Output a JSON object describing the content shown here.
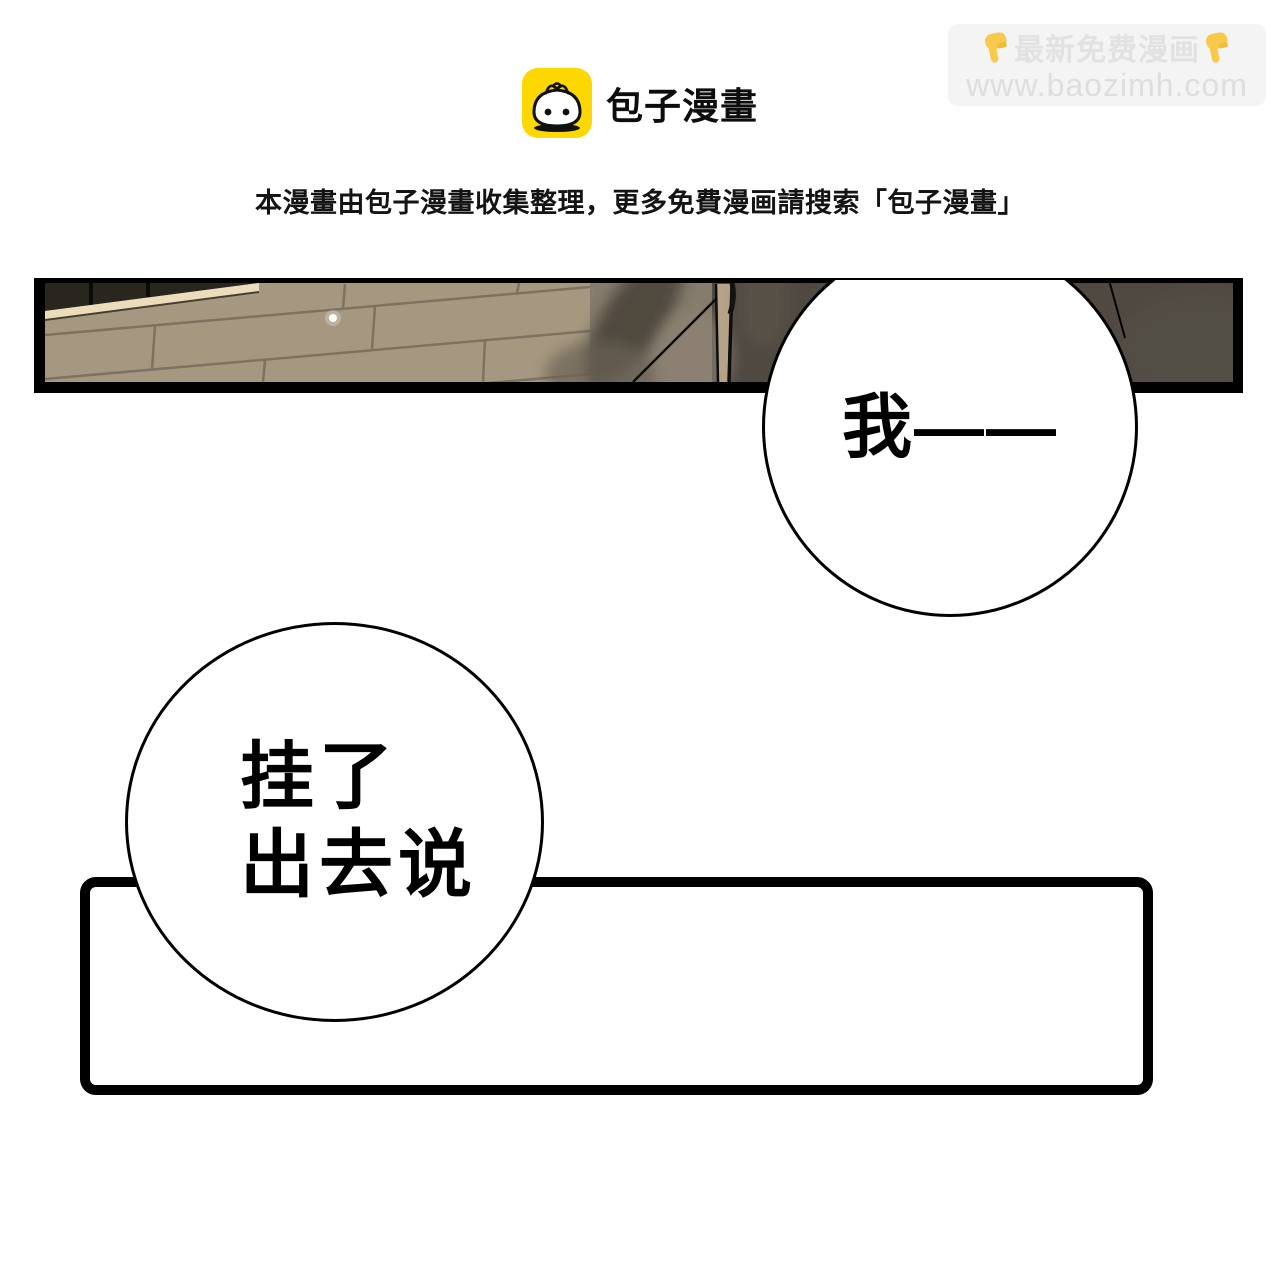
{
  "watermark": {
    "line1": "最新免费漫画",
    "line2": "www.baozimh.com",
    "hand_icon": "pointing-down-hand",
    "bg_color": "#f4f4f4",
    "text_color": "#e2e2e2",
    "hand_color": "#f8c94a"
  },
  "header": {
    "brand": "包子漫畫",
    "logo_icon": "baozi-bun-face",
    "logo_bg_color": "#fcd800",
    "notice": "本漫畫由包子漫畫收集整理，更多免費漫画請搜索「包子漫畫」"
  },
  "comic": {
    "panel_colors": {
      "border": "#000000",
      "brick": "#a69880",
      "mortar": "#7d7260",
      "trim": "#ecdcbb",
      "dark_figure": "#4f4942",
      "blurred_wall": "#867c6d",
      "skin_sliver": "#b5a288"
    },
    "bubbles": [
      {
        "text": "我——"
      },
      {
        "lines": [
          "挂了",
          "出去说"
        ]
      }
    ],
    "caption_box_text": ""
  }
}
